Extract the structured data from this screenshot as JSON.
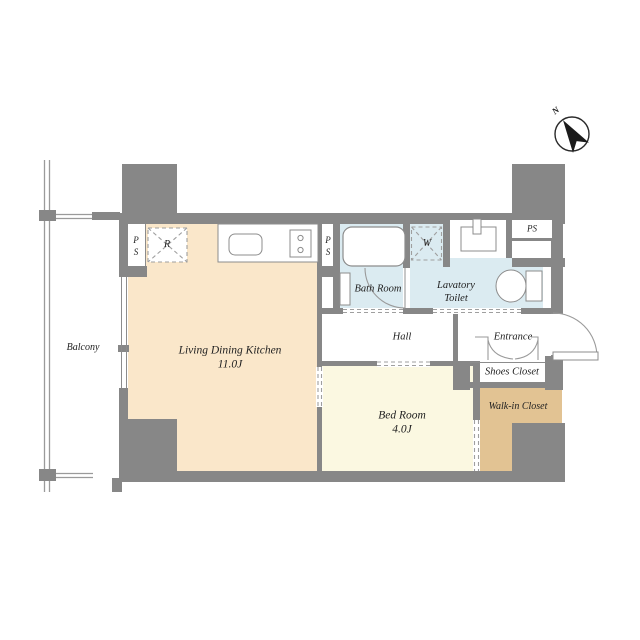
{
  "colors": {
    "wall": "#878787",
    "ldk": "#FAE7CA",
    "bedroom": "#FBF8E1",
    "wet": "#DBEBF1",
    "closet": "#E2C393",
    "line": "#8c8c8c",
    "text": "#222222"
  },
  "compass": {
    "label": "N"
  },
  "rooms": {
    "balcony": {
      "label": "Balcony"
    },
    "ldk": {
      "label": "Living Dining Kitchen",
      "size": "11.0J"
    },
    "bedroom": {
      "label": "Bed Room",
      "size": "4.0J"
    },
    "bathroom": {
      "label": "Bath Room"
    },
    "lavatory": {
      "line1": "Lavatory",
      "line2": "Toilet"
    },
    "hall": {
      "label": "Hall"
    },
    "entrance": {
      "label": "Entrance"
    },
    "shoes_closet": {
      "label": "Shoes Closet"
    },
    "walk_in_closet": {
      "label": "Walk-in Closet"
    }
  },
  "fixtures": {
    "refrigerator": "R",
    "washer": "W",
    "ps_left": "PS",
    "ps_mid": "PS",
    "ps_right": "PS"
  }
}
